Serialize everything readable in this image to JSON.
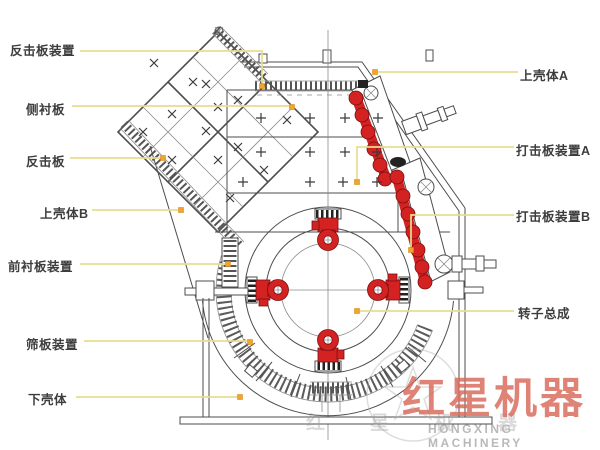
{
  "title": "impact crusher structure diagram",
  "colors": {
    "part_red": "#d42222",
    "leader_line": "#e6dd8e",
    "leader_dot": "#f2a52e",
    "line_art": "#4d4d4d",
    "watermark_red": "#d8695a",
    "watermark_gray": "#b9b9b9"
  },
  "watermark": {
    "brand_cn": "红星机器",
    "brand_en": "HONGXING MACHINERY",
    "faint_row": "红星机器"
  },
  "labels": [
    {
      "name": "impact-plate-assembly-label",
      "text": "反击板装置",
      "x": 10,
      "y": 40,
      "leader": [
        [
          80,
          51
        ],
        [
          262,
          51
        ],
        [
          262,
          83
        ]
      ],
      "dot": [
        262,
        86
      ]
    },
    {
      "name": "side-liner-label",
      "text": "侧衬板",
      "x": 26,
      "y": 99,
      "leader": [
        [
          72,
          106
        ],
        [
          289,
          106
        ]
      ],
      "dot": [
        292,
        107
      ]
    },
    {
      "name": "impact-plate-label",
      "text": "反击板",
      "x": 26,
      "y": 151,
      "leader": [
        [
          70,
          158
        ],
        [
          160,
          158
        ]
      ],
      "dot": [
        163,
        158
      ]
    },
    {
      "name": "upper-shell-b-label",
      "text": "上壳体B",
      "x": 40,
      "y": 203,
      "leader": [
        [
          92,
          210
        ],
        [
          178,
          210
        ]
      ],
      "dot": [
        181,
        210
      ]
    },
    {
      "name": "front-liner-assembly-label",
      "text": "前衬板装置",
      "x": 8,
      "y": 256,
      "leader": [
        [
          80,
          264
        ],
        [
          225,
          264
        ]
      ],
      "dot": [
        228,
        264
      ]
    },
    {
      "name": "screen-plate-assembly-label",
      "text": "筛板装置",
      "x": 26,
      "y": 334,
      "leader": [
        [
          84,
          341
        ],
        [
          247,
          341
        ]
      ],
      "dot": [
        250,
        342
      ]
    },
    {
      "name": "lower-shell-label",
      "text": "下壳体",
      "x": 28,
      "y": 389,
      "leader": [
        [
          76,
          397
        ],
        [
          237,
          397
        ]
      ],
      "dot": [
        240,
        397
      ]
    },
    {
      "name": "upper-shell-a-label",
      "text": "上壳体A",
      "x": 520,
      "y": 65,
      "leader": [
        [
          518,
          72
        ],
        [
          378,
          72
        ]
      ],
      "dot": [
        375,
        72
      ]
    },
    {
      "name": "blow-bar-assembly-a-label",
      "text": "打击板装置A",
      "x": 516,
      "y": 140,
      "leader": [
        [
          514,
          147
        ],
        [
          357,
          147
        ],
        [
          357,
          179
        ]
      ],
      "dot": [
        357,
        182
      ]
    },
    {
      "name": "blow-bar-assembly-b-label",
      "text": "打击板装置B",
      "x": 516,
      "y": 206,
      "leader": [
        [
          514,
          215
        ],
        [
          411,
          215
        ],
        [
          411,
          247
        ]
      ],
      "dot": [
        411,
        250
      ]
    },
    {
      "name": "rotor-assembly-label",
      "text": "转子总成",
      "x": 518,
      "y": 303,
      "leader": [
        [
          514,
          311
        ],
        [
          360,
          311
        ]
      ],
      "dot": [
        357,
        311
      ]
    }
  ],
  "diagram": {
    "plus_marks": [
      [
        261,
        118
      ],
      [
        310,
        118
      ],
      [
        345,
        118
      ],
      [
        378,
        118
      ],
      [
        261,
        152
      ],
      [
        310,
        152
      ],
      [
        345,
        152
      ],
      [
        377,
        152
      ],
      [
        243,
        182
      ],
      [
        310,
        182
      ],
      [
        343,
        182
      ],
      [
        377,
        182
      ]
    ],
    "cross_marks": [
      [
        154,
        63
      ],
      [
        206,
        84
      ],
      [
        238,
        100
      ],
      [
        287,
        120
      ],
      [
        172,
        114
      ],
      [
        218,
        107
      ],
      [
        206,
        131
      ],
      [
        238,
        147
      ],
      [
        143,
        132
      ],
      [
        172,
        160
      ],
      [
        218,
        160
      ],
      [
        264,
        170
      ],
      [
        230,
        198
      ],
      [
        193,
        82
      ]
    ]
  }
}
